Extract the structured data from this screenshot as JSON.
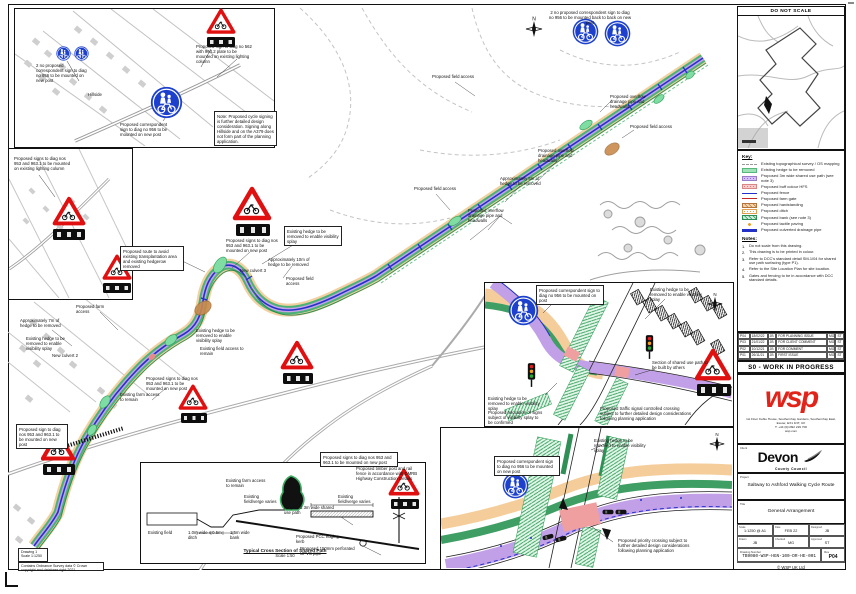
{
  "keyplan": {
    "title": "DO NOT SCALE"
  },
  "legend": {
    "heading": "Key:",
    "items": [
      {
        "type": "line-dash-gray",
        "label": "Existing topographical survey / OS mapping"
      },
      {
        "type": "chip-green",
        "label": "Existing hedge to be removed"
      },
      {
        "type": "chip-purple",
        "label": "Proposed 3m wide shared use path (see note 3)"
      },
      {
        "type": "chip-pink",
        "label": "Proposed buff colour HFS"
      },
      {
        "type": "line-blue",
        "label": "Proposed fence"
      },
      {
        "type": "line-red",
        "label": "Proposed farm gate"
      },
      {
        "type": "chip-tan",
        "label": "Proposed hardstanding"
      },
      {
        "type": "chip-dots",
        "label": "Proposed ditch"
      },
      {
        "type": "chip-greenhatch",
        "label": "Proposed bank (see note 3)"
      },
      {
        "type": "tick-orange",
        "label": "Proposed tactile paving"
      },
      {
        "type": "line-blue-thick",
        "label": "Proposed culverted drainage pipe"
      }
    ],
    "notes_heading": "Notes:",
    "notes": [
      {
        "n": "1.",
        "t": "Do not scale from this drawing."
      },
      {
        "n": "2.",
        "t": "This drawing is to be printed in colour."
      },
      {
        "n": "3.",
        "t": "Refer to DCC's standard detail SM-1/04 for shared use path surfacing (type P1)."
      },
      {
        "n": "4.",
        "t": "Refer to the Site Location Plan for site location."
      },
      {
        "n": "5.",
        "t": "Gates and fencing to be in accordance with DCC standard details."
      }
    ]
  },
  "revisions": {
    "rows": [
      {
        "r": "P04",
        "d": "18/02/22",
        "b": "JB",
        "t": "FOR PLANNING ISSUE",
        "c": "MG",
        "a": "ST"
      },
      {
        "r": "P03",
        "d": "21/01/22",
        "b": "JB",
        "t": "FOR CLIENT COMMENT",
        "c": "MG",
        "a": "ST"
      },
      {
        "r": "P02",
        "d": "10/12/21",
        "b": "JB",
        "t": "FOR COMMENT",
        "c": "MG",
        "a": "ST"
      },
      {
        "r": "P01",
        "d": "26/11/21",
        "b": "JB",
        "t": "FIRST ISSUE",
        "c": "MG",
        "a": "ST"
      },
      {
        "r": "REV",
        "d": "DATE",
        "b": "BY",
        "t": "DESCRIPTION",
        "c": "CHK",
        "a": "APP",
        "cls": "hdr"
      }
    ]
  },
  "status_banner": "S0 - WORK IN PROGRESS",
  "wsp": {
    "name": "wsp",
    "address": "1st Floor Keble House, Southernhay Gardens, Southernhay East, Exeter, EX1 1NT, UK",
    "phone": "T: +44 (0)1392 229 700",
    "web": "wsp.com"
  },
  "client": {
    "label": "Client",
    "name": "Devon",
    "sub": "County Council"
  },
  "project": {
    "label": "Project",
    "name": "Saltway to Ashford Walking Cycle Route"
  },
  "title_block": {
    "label": "Title",
    "name": "General Arrangement",
    "fields": [
      {
        "label": "Scale",
        "value": "1:1250 @ A1"
      },
      {
        "label": "Date",
        "value": "FEB 22"
      },
      {
        "label": "Designed",
        "value": "JB"
      },
      {
        "label": "Drawn",
        "value": "JB"
      },
      {
        "label": "Checked",
        "value": "MG"
      },
      {
        "label": "Approved",
        "value": "ST"
      }
    ],
    "drawing_label": "Drawing Number",
    "drawing_number": "TB9080-WSP-HGN-100-DR-HE-001",
    "rev_label": "Rev",
    "revision": "P04",
    "copyright": "© WSP UK Ltd"
  },
  "footer": {
    "sheet_ref": "Drawing 1",
    "scale": "Scale 1:1250",
    "os_credit": "Contains Ordnance Survey data © Crown copyright and database right 2021"
  },
  "section": {
    "title": "Typical Cross Section of Shared Path",
    "scale": "Scale 1:50"
  },
  "annotations": [
    {
      "t": "2 no proposed correspondent sign to diag no 956 to be mounted on new post",
      "x": 36,
      "y": 63,
      "w": 52
    },
    {
      "t": "Proposed sign to diag no 562 with 964.2 plate to be mounted on existing lighting column",
      "x": 196,
      "y": 44,
      "w": 58
    },
    {
      "t": "Proposed correspondent sign to diag no 956 to be mounted on new post",
      "x": 120,
      "y": 122,
      "w": 55
    },
    {
      "t": "Note: Proposed cycle signing is further detailed design consideration. Signing along Hillside and on the A379 does not form part of the planning application.",
      "x": 214,
      "y": 111,
      "w": 57,
      "boxed": 1
    },
    {
      "t": "Hillside",
      "x": 88,
      "y": 92,
      "w": 30
    },
    {
      "t": "Proposed signs to diag nos 953 and 963.1 to be mounted on existing lighting column",
      "x": 14,
      "y": 156,
      "w": 60
    },
    {
      "t": "2 no proposed correspondent sign to diag no 956 to be mounted back to back on new post",
      "x": 548,
      "y": 10,
      "w": 84,
      "ta": "center"
    },
    {
      "t": "Proposed field access",
      "x": 432,
      "y": 74,
      "w": 48
    },
    {
      "t": "Proposed overflow drainage pipe and headwalls",
      "x": 610,
      "y": 94,
      "w": 52
    },
    {
      "t": "Proposed field access",
      "x": 630,
      "y": 124,
      "w": 46
    },
    {
      "t": "Approximately 5m of hedge to be removed",
      "x": 500,
      "y": 176,
      "w": 50
    },
    {
      "t": "Proposed overflow drainage pipe and headwalls",
      "x": 538,
      "y": 148,
      "w": 52
    },
    {
      "t": "Proposed field access",
      "x": 414,
      "y": 186,
      "w": 44
    },
    {
      "t": "Proposed overflow drainage pipe and headwalls",
      "x": 468,
      "y": 208,
      "w": 52
    },
    {
      "t": "Proposed route to avoid existing transplantation area and existing hedgerow removed",
      "x": 120,
      "y": 246,
      "w": 58,
      "boxed": 1
    },
    {
      "t": "Proposed signs to diag nos 953 and 963.1 to be mounted on new post",
      "x": 226,
      "y": 238,
      "w": 54
    },
    {
      "t": "Approximately 10m of hedge to be removed",
      "x": 268,
      "y": 257,
      "w": 46
    },
    {
      "t": "Proposed field access",
      "x": 286,
      "y": 276,
      "w": 40
    },
    {
      "t": "Existing hedge to be removed to enable visibility splay",
      "x": 284,
      "y": 226,
      "w": 52,
      "boxed": 1
    },
    {
      "t": "New culvert 3",
      "x": 240,
      "y": 268,
      "w": 30
    },
    {
      "t": "Proposed farm access",
      "x": 76,
      "y": 304,
      "w": 40
    },
    {
      "t": "Approximately 7m of hedge to be removed",
      "x": 20,
      "y": 318,
      "w": 44
    },
    {
      "t": "Existing hedge to be removed to enable visibility splay",
      "x": 26,
      "y": 336,
      "w": 48
    },
    {
      "t": "New culvert 2",
      "x": 52,
      "y": 353,
      "w": 28
    },
    {
      "t": "Existing hedge to be removed to enable visibility splay",
      "x": 196,
      "y": 328,
      "w": 50
    },
    {
      "t": "Existing field access to remain",
      "x": 200,
      "y": 346,
      "w": 44
    },
    {
      "t": "Proposed signs to diag nos 953 and 963.1 to be mounted on new post",
      "x": 146,
      "y": 376,
      "w": 54
    },
    {
      "t": "Existing farm access to remain",
      "x": 120,
      "y": 392,
      "w": 40
    },
    {
      "t": "Proposed sign to diag nos 953 and 963.1 to be mounted on new post",
      "x": 16,
      "y": 424,
      "w": 46,
      "boxed": 1
    },
    {
      "t": "Existing farm access to remain",
      "x": 226,
      "y": 478,
      "w": 44
    },
    {
      "t": "Proposed signs to diag nos 953 and 963.1 to be mounted on new post",
      "x": 320,
      "y": 452,
      "w": 72,
      "boxed": 1
    },
    {
      "t": "Proposed correspondent sign to diag no 956 to be mounted on post",
      "x": 536,
      "y": 285,
      "w": 62,
      "boxed": 1
    },
    {
      "t": "Existing hedge to be removed to enable visibility splay",
      "x": 650,
      "y": 287,
      "w": 56
    },
    {
      "t": "Section of shared use path to be built by others",
      "x": 652,
      "y": 360,
      "w": 56
    },
    {
      "t": "Existing hedge to be removed to enable visibility splay",
      "x": 488,
      "y": 396,
      "w": 52
    },
    {
      "t": "Proposed relocation of signs subject of visibility splay to be confirmed",
      "x": 488,
      "y": 410,
      "w": 56
    },
    {
      "t": "Proposed traffic signal controlled crossing subject to further detailed design considerations following planning application",
      "x": 600,
      "y": 406,
      "w": 92
    },
    {
      "t": "Existing hedge to be removed to enable visibility splay",
      "x": 594,
      "y": 438,
      "w": 56
    },
    {
      "t": "Proposed correspondent sign to diag no 956 to be mounted on new post",
      "x": 494,
      "y": 456,
      "w": 60,
      "boxed": 1
    },
    {
      "t": "Proposed priority crossing subject to further detailed design considerations following planning application",
      "x": 618,
      "y": 538,
      "w": 82
    },
    {
      "t": "Existing field",
      "x": 148,
      "y": 530,
      "w": 30
    },
    {
      "t": "1.0m wide x 0.5m ditch",
      "x": 188,
      "y": 530,
      "w": 34
    },
    {
      "t": "1.5m wide bank",
      "x": 230,
      "y": 530,
      "w": 30
    },
    {
      "t": "Existing field/verge varies",
      "x": 244,
      "y": 494,
      "w": 34
    },
    {
      "t": "Proposed 3m wide shared use path",
      "x": 284,
      "y": 505,
      "w": 56
    },
    {
      "t": "Existing field/verge varies",
      "x": 338,
      "y": 494,
      "w": 34
    },
    {
      "t": "Proposed PCC edging kerb",
      "x": 296,
      "y": 534,
      "w": 44
    },
    {
      "t": "Proposed 150mm perforated UPVC pipe",
      "x": 300,
      "y": 546,
      "w": 62
    },
    {
      "t": "Proposed timber post and rail fence in accordance with DMRB Highway Construction Details",
      "x": 356,
      "y": 466,
      "w": 62
    }
  ]
}
